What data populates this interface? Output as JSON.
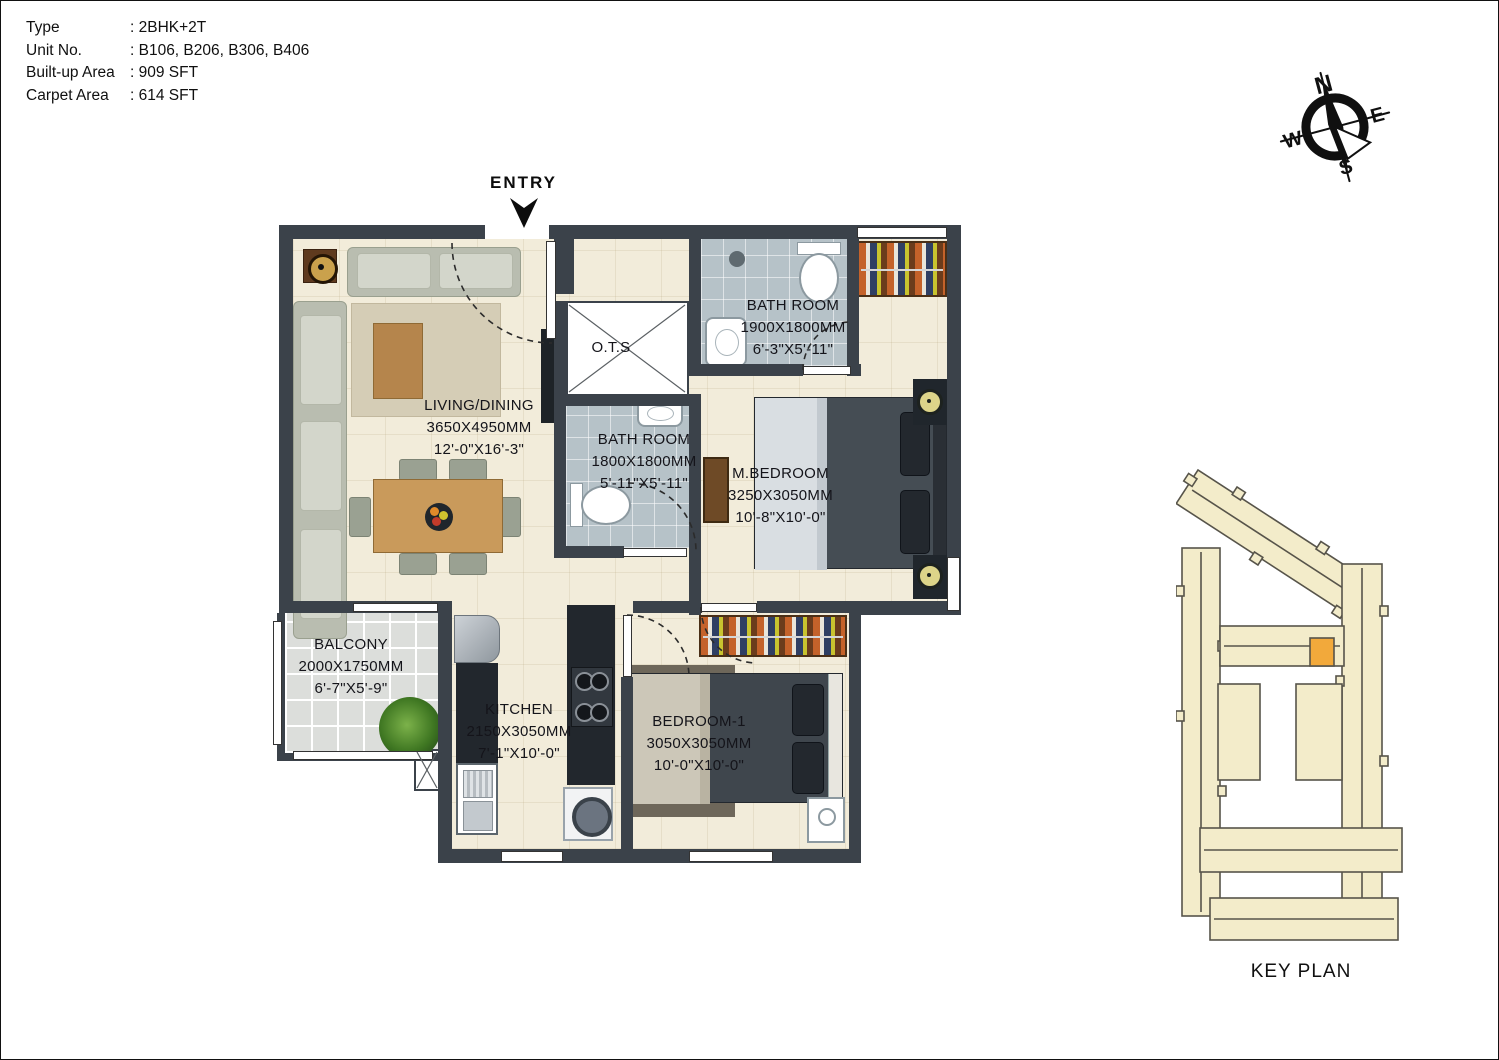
{
  "title_block": {
    "rows": [
      {
        "label": "Type",
        "value": ": 2BHK+2T"
      },
      {
        "label": "Unit No.",
        "value": ": B106, B206, B306, B406"
      },
      {
        "label": "Built-up Area",
        "value": ": 909 SFT"
      },
      {
        "label": "Carpet Area",
        "value": ": 614 SFT"
      }
    ]
  },
  "entry_label": "ENTRY",
  "compass": {
    "north": "N",
    "east": "E",
    "west": "W",
    "south": "S"
  },
  "rooms": {
    "living_dining": {
      "name": "LIVING/DINING",
      "size_mm": "3650X4950MM",
      "size_ft": "12'-0\"X16'-3\""
    },
    "ots": {
      "name": "O.T.S"
    },
    "bath_top": {
      "name": "BATH ROOM",
      "size_mm": "1900X1800MM",
      "size_ft": "6'-3\"X5'-11\""
    },
    "bath_mid": {
      "name": "BATH ROOM",
      "size_mm": "1800X1800MM",
      "size_ft": "5'-11\"X5'-11\""
    },
    "master_bedroom": {
      "name": "M.BEDROOM",
      "size_mm": "3250X3050MM",
      "size_ft": "10'-8\"X10'-0\""
    },
    "balcony": {
      "name": "BALCONY",
      "size_mm": "2000X1750MM",
      "size_ft": "6'-7\"X5'-9\""
    },
    "kitchen": {
      "name": "KITCHEN",
      "size_mm": "2150X3050MM",
      "size_ft": "7'-1\"X10'-0\""
    },
    "bedroom_1": {
      "name": "BEDROOM-1",
      "size_mm": "3050X3050MM",
      "size_ft": "10'-0\"X10'-0\""
    }
  },
  "key_plan": {
    "label": "KEY PLAN"
  },
  "colors": {
    "wall": "#3b424a",
    "floor": "#f2ecda",
    "bath_floor": "#b6c2c8",
    "balcony_floor": "#dcdedb",
    "wardrobe_wood": "#7a4a28",
    "keyplan_building": "#f3ecca",
    "keyplan_outline": "#57544a",
    "keyplan_highlight": "#f2a93b"
  }
}
